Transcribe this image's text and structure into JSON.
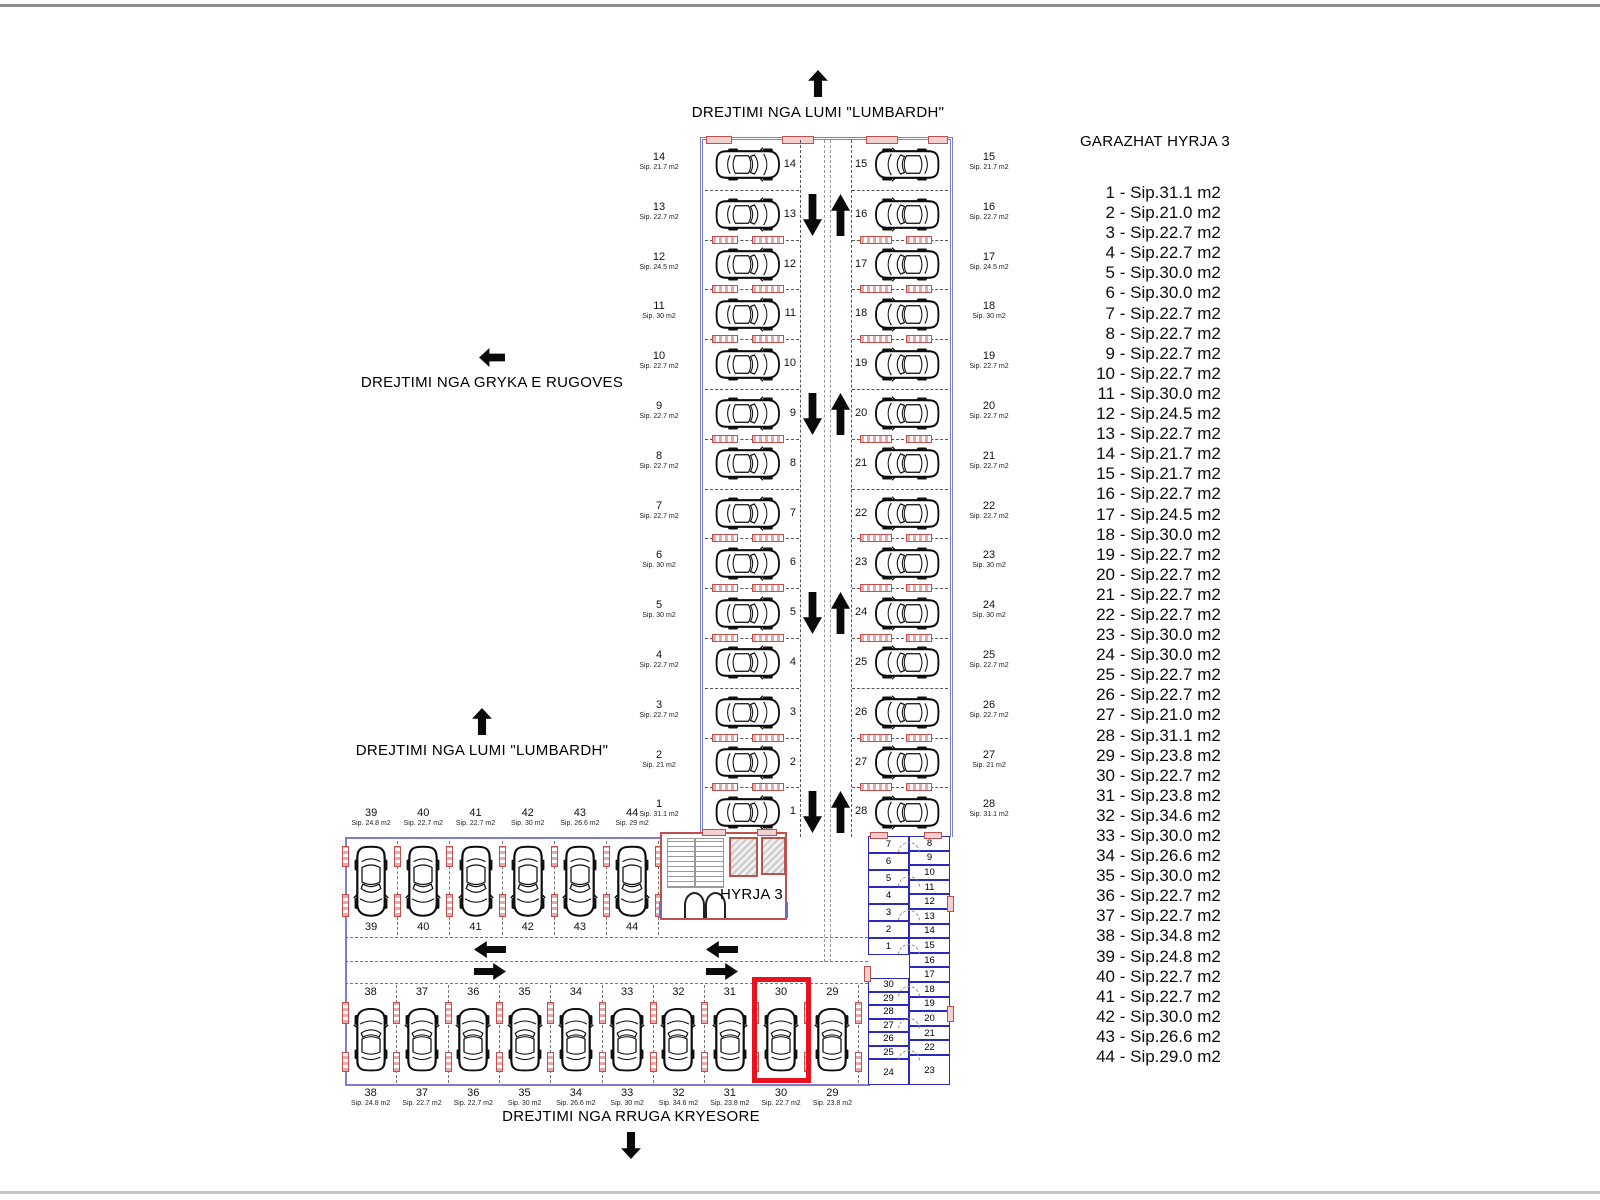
{
  "directions": {
    "top": "DREJTIMI NGA LUMI \"LUMBARDH\"",
    "left": "DREJTIMI NGA GRYKA E RUGOVES",
    "mid": "DREJTIMI NGA LUMI \"LUMBARDH\"",
    "bottom": "DREJTIMI NGA RRUGA KRYESORE"
  },
  "entrance": {
    "label": "HYRJA 3"
  },
  "legend": {
    "title": "GARAZHAT HYRJA 3",
    "items": [
      {
        "num": "1",
        "area": "Sip.31.1 m2"
      },
      {
        "num": "2",
        "area": "Sip.21.0 m2"
      },
      {
        "num": "3",
        "area": "Sip.22.7 m2"
      },
      {
        "num": "4",
        "area": "Sip.22.7 m2"
      },
      {
        "num": "5",
        "area": "Sip.30.0 m2"
      },
      {
        "num": "6",
        "area": "Sip.30.0 m2"
      },
      {
        "num": "7",
        "area": "Sip.22.7 m2"
      },
      {
        "num": "8",
        "area": "Sip.22.7 m2"
      },
      {
        "num": "9",
        "area": "Sip.22.7 m2"
      },
      {
        "num": "10",
        "area": "Sip.22.7 m2"
      },
      {
        "num": "11",
        "area": "Sip.30.0 m2"
      },
      {
        "num": "12",
        "area": "Sip.24.5 m2"
      },
      {
        "num": "13",
        "area": "Sip.22.7 m2"
      },
      {
        "num": "14",
        "area": "Sip.21.7 m2"
      },
      {
        "num": "15",
        "area": "Sip.21.7 m2"
      },
      {
        "num": "16",
        "area": "Sip.22.7 m2"
      },
      {
        "num": "17",
        "area": "Sip.24.5 m2"
      },
      {
        "num": "18",
        "area": "Sip.30.0 m2"
      },
      {
        "num": "19",
        "area": "Sip.22.7 m2"
      },
      {
        "num": "20",
        "area": "Sip.22.7 m2"
      },
      {
        "num": "21",
        "area": "Sip.22.7 m2"
      },
      {
        "num": "22",
        "area": "Sip.22.7 m2"
      },
      {
        "num": "23",
        "area": "Sip.30.0 m2"
      },
      {
        "num": "24",
        "area": "Sip.30.0 m2"
      },
      {
        "num": "25",
        "area": "Sip.22.7 m2"
      },
      {
        "num": "26",
        "area": "Sip.22.7 m2"
      },
      {
        "num": "27",
        "area": "Sip.21.0 m2"
      },
      {
        "num": "28",
        "area": "Sip.31.1 m2"
      },
      {
        "num": "29",
        "area": "Sip.23.8 m2"
      },
      {
        "num": "30",
        "area": "Sip.22.7 m2"
      },
      {
        "num": "31",
        "area": "Sip.23.8 m2"
      },
      {
        "num": "32",
        "area": "Sip.34.6 m2"
      },
      {
        "num": "33",
        "area": "Sip.30.0 m2"
      },
      {
        "num": "34",
        "area": "Sip.26.6 m2"
      },
      {
        "num": "35",
        "area": "Sip.30.0 m2"
      },
      {
        "num": "36",
        "area": "Sip.22.7 m2"
      },
      {
        "num": "37",
        "area": "Sip.22.7 m2"
      },
      {
        "num": "38",
        "area": "Sip.34.8 m2"
      },
      {
        "num": "39",
        "area": "Sip.24.8 m2"
      },
      {
        "num": "40",
        "area": "Sip.22.7 m2"
      },
      {
        "num": "41",
        "area": "Sip.22.7 m2"
      },
      {
        "num": "42",
        "area": "Sip.30.0 m2"
      },
      {
        "num": "43",
        "area": "Sip.26.6 m2"
      },
      {
        "num": "44",
        "area": "Sip.29.0 m2"
      }
    ]
  },
  "vertical_garage": {
    "rows": [
      {
        "left_num": "14",
        "left_area": "Sip. 21.7 m2",
        "right_num": "15",
        "right_area": "Sip. 21.7 m2",
        "arrows": false,
        "red_top": false
      },
      {
        "left_num": "13",
        "left_area": "Sip. 22.7 m2",
        "right_num": "16",
        "right_area": "Sip. 22.7 m2",
        "arrows": true,
        "red_top": false
      },
      {
        "left_num": "12",
        "left_area": "Sip. 24.5 m2",
        "right_num": "17",
        "right_area": "Sip. 24.5 m2",
        "arrows": false,
        "red_top": true
      },
      {
        "left_num": "11",
        "left_area": "Sip. 30 m2",
        "right_num": "18",
        "right_area": "Sip. 30 m2",
        "arrows": false,
        "red_top": true
      },
      {
        "left_num": "10",
        "left_area": "Sip. 22.7 m2",
        "right_num": "19",
        "right_area": "Sip. 22.7 m2",
        "arrows": false,
        "red_top": true
      },
      {
        "left_num": "9",
        "left_area": "Sip. 22.7 m2",
        "right_num": "20",
        "right_area": "Sip. 22.7 m2",
        "arrows": true,
        "red_top": false
      },
      {
        "left_num": "8",
        "left_area": "Sip. 22.7 m2",
        "right_num": "21",
        "right_area": "Sip. 22.7 m2",
        "arrows": false,
        "red_top": true
      },
      {
        "left_num": "7",
        "left_area": "Sip. 22.7 m2",
        "right_num": "22",
        "right_area": "Sip. 22.7 m2",
        "arrows": false,
        "red_top": false
      },
      {
        "left_num": "6",
        "left_area": "Sip. 30 m2",
        "right_num": "23",
        "right_area": "Sip. 30 m2",
        "arrows": false,
        "red_top": true
      },
      {
        "left_num": "5",
        "left_area": "Sip. 30 m2",
        "right_num": "24",
        "right_area": "Sip. 30 m2",
        "arrows": true,
        "red_top": true
      },
      {
        "left_num": "4",
        "left_area": "Sip. 22.7 m2",
        "right_num": "25",
        "right_area": "Sip. 22.7 m2",
        "arrows": false,
        "red_top": true
      },
      {
        "left_num": "3",
        "left_area": "Sip. 22.7 m2",
        "right_num": "26",
        "right_area": "Sip. 22.7 m2",
        "arrows": false,
        "red_top": false
      },
      {
        "left_num": "2",
        "left_area": "Sip. 21 m2",
        "right_num": "27",
        "right_area": "Sip. 21 m2",
        "arrows": false,
        "red_top": true
      },
      {
        "left_num": "1",
        "left_area": "Sip. 31.1 m2",
        "right_num": "28",
        "right_area": "Sip. 31.1 m2",
        "arrows": true,
        "red_top": true
      }
    ]
  },
  "upper_row": {
    "stalls": [
      {
        "num": "39",
        "area": "Sip. 24.8 m2"
      },
      {
        "num": "40",
        "area": "Sip. 22.7 m2"
      },
      {
        "num": "41",
        "area": "Sip. 22.7 m2"
      },
      {
        "num": "42",
        "area": "Sip. 30 m2"
      },
      {
        "num": "43",
        "area": "Sip. 26.6 m2"
      },
      {
        "num": "44",
        "area": "Sip. 29 m2"
      }
    ]
  },
  "bottom_row": {
    "highlighted_stall": "30",
    "stalls": [
      {
        "num": "38",
        "area": "Sip. 24.8 m2"
      },
      {
        "num": "37",
        "area": "Sip. 22.7 m2"
      },
      {
        "num": "36",
        "area": "Sip. 22.7 m2"
      },
      {
        "num": "35",
        "area": "Sip. 30 m2"
      },
      {
        "num": "34",
        "area": "Sip. 26.6 m2"
      },
      {
        "num": "33",
        "area": "Sip. 30 m2"
      },
      {
        "num": "32",
        "area": "Sip. 34.6 m2"
      },
      {
        "num": "31",
        "area": "Sip. 23.8 m2"
      },
      {
        "num": "30",
        "area": "Sip. 22.7 m2",
        "highlighted": true
      },
      {
        "num": "29",
        "area": "Sip. 23.8 m2"
      }
    ]
  },
  "storage": {
    "left_top": [
      "7",
      "6",
      "5",
      "4",
      "3",
      "2",
      "1"
    ],
    "right": [
      "8",
      "9",
      "10",
      "11",
      "12",
      "13",
      "14",
      "15",
      "16",
      "17",
      "18",
      "19",
      "20",
      "21",
      "22",
      "23"
    ],
    "left_bottom": [
      "30",
      "29",
      "28",
      "27",
      "26",
      "25",
      "24"
    ]
  },
  "colors": {
    "highlight": "#e8121d",
    "wall": "#7d7dd0",
    "storage_wall": "#2a2ac0",
    "entrance_wall": "#c0504d"
  }
}
